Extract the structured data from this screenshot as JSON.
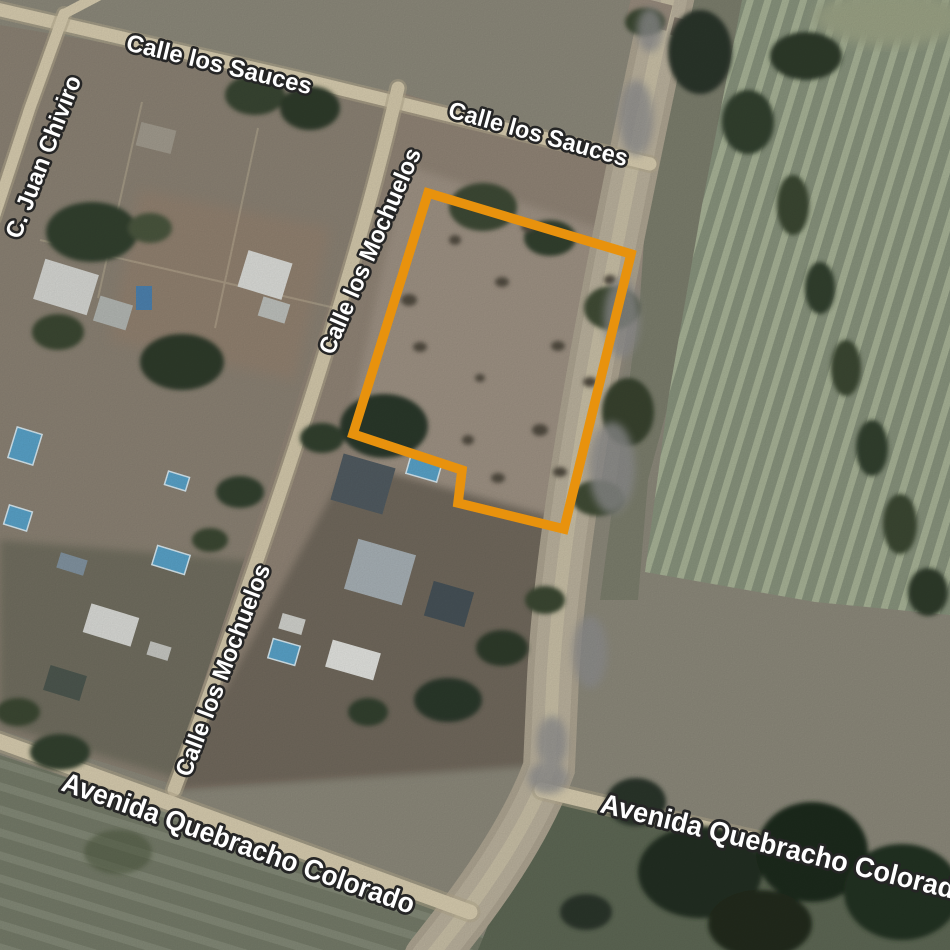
{
  "map": {
    "view_type": "satellite",
    "street_labels": [
      {
        "name": "Calle los Sauces"
      },
      {
        "name": "Calle los Sauces"
      },
      {
        "name": "C. Juan Chiviro"
      },
      {
        "name": "Calle los Mochuelos"
      },
      {
        "name": "Calle los Mochuelos"
      },
      {
        "name": "Avenida Quebracho Colorado"
      },
      {
        "name": "Avenida Quebracho Colorado"
      }
    ],
    "label_style": {
      "text_color": "#ffffff",
      "outline_color": "#252525"
    },
    "plot_outline": {
      "points": "428,193 631,254 564,529 458,503 462,470 353,434",
      "color": "#E8920D",
      "stroke_width": 9.5
    }
  }
}
